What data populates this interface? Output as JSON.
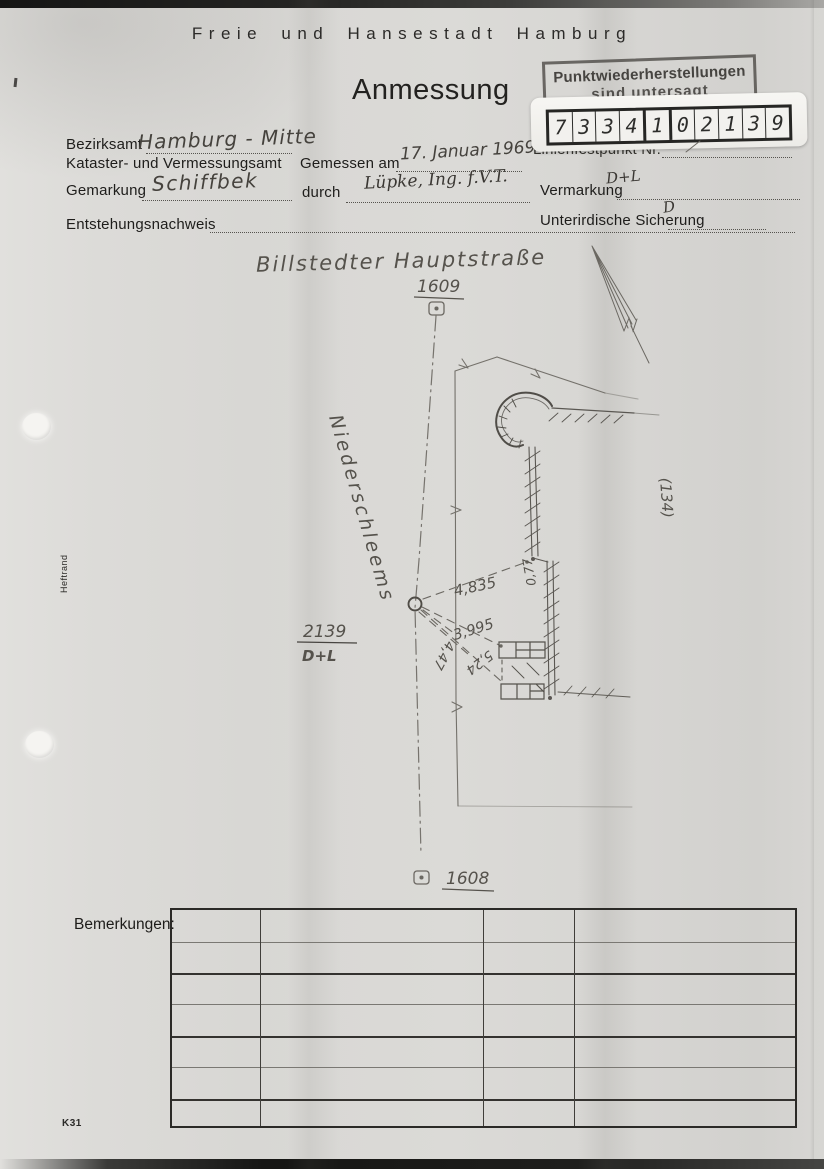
{
  "header": {
    "city": "Freie und Hansestadt Hamburg",
    "title": "Anmessung"
  },
  "stamp": {
    "line1": "Punktwiederherstellungen",
    "line2": "sind untersagt"
  },
  "point_id": {
    "digits": [
      "7",
      "3",
      "3",
      "4",
      "1",
      "0",
      "2",
      "1",
      "3",
      "9"
    ]
  },
  "form": {
    "bezirksamt_label": "Bezirksamt",
    "bezirksamt_label2": "Kataster- und Vermessungsamt",
    "bezirksamt_value": "Hamburg - Mitte",
    "gemessen_label": "Gemessen am",
    "gemessen_value": "17. Januar 1969",
    "gemarkung_label": "Gemarkung",
    "gemarkung_value": "Schiffbek",
    "durch_label": "durch",
    "durch_value": "Lüpke, Ing. f.V.T.",
    "linienfestpunkt_label": "Linienfestpunkt Nr.",
    "vermarkung_label": "Vermarkung",
    "vermarkung_value": "D+L",
    "entstehung_label": "Entstehungsnachweis",
    "sicherung_label": "Unterirdische Sicherung",
    "sicherung_value": "D"
  },
  "sketch": {
    "street": "Billstedter Hauptstraße",
    "road": "Niederschleems",
    "point_top": "1609",
    "point_bottom": "1608",
    "station_number": "2139",
    "station_mark": "D+L",
    "parcel": "(134)",
    "measurements": [
      "4,835",
      "0,77",
      "3,995",
      "5,24",
      "4,47"
    ]
  },
  "remarks": {
    "label": "Bemerkungen:",
    "rows": 7,
    "columns": 4
  },
  "footer": {
    "form_code": "K31"
  },
  "margin": {
    "label": "Heftrand"
  },
  "colors": {
    "paper": "#d8d7d4",
    "ink": "#1e1d1b",
    "pencil": "#55524c",
    "stamp_ink": "#3e3c37"
  }
}
